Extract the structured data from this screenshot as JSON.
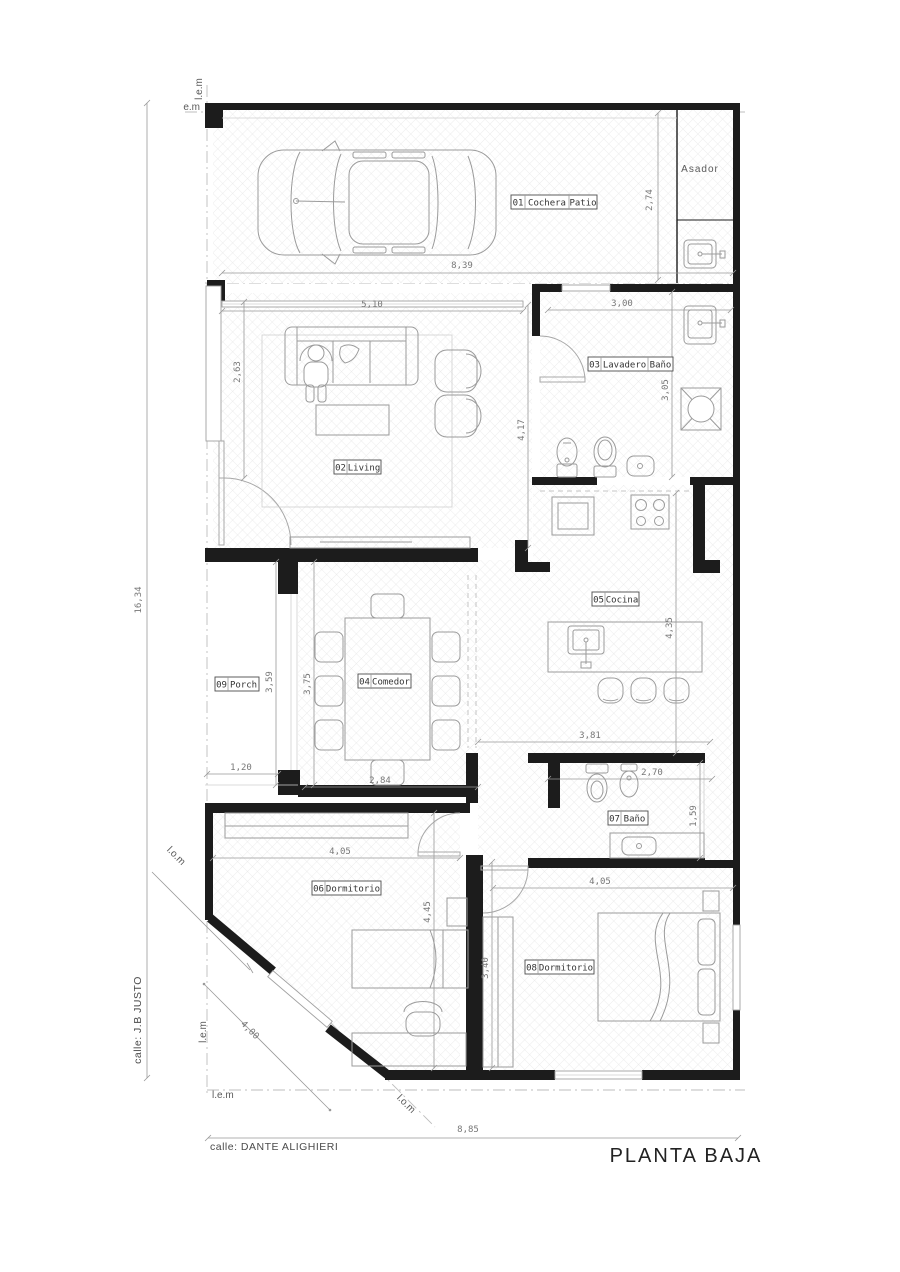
{
  "title": "PLANTA BAJA",
  "streets": {
    "left": "calle: J.B JUSTO",
    "bottom": "calle: DANTE ALIGHIERI"
  },
  "site_labels": {
    "lem_top": "l.e.m",
    "em": "e.m",
    "lem_bottom_v": "l.e.m",
    "lem_bottom_h": "l.e.m",
    "lom_upper": "l.o.m",
    "lom_lower": "l.o.m",
    "asador": "Asador"
  },
  "rooms": [
    {
      "num": "01",
      "name": "Cochera",
      "name2": "Patio"
    },
    {
      "num": "02",
      "name": "Living"
    },
    {
      "num": "03",
      "name": "Lavadero",
      "name2": "Baño"
    },
    {
      "num": "04",
      "name": "Comedor"
    },
    {
      "num": "05",
      "name": "Cocina"
    },
    {
      "num": "06",
      "name": "Dormitorio"
    },
    {
      "num": "07",
      "name": "Baño"
    },
    {
      "num": "08",
      "name": "Dormitorio"
    },
    {
      "num": "09",
      "name": "Porch"
    }
  ],
  "dimensions": {
    "lot_depth": "16,34",
    "lot_width_bottom": "8,85",
    "garage_width": "8,39",
    "garage_height": "2,74",
    "living_width": "5,10",
    "living_partial": "2,63",
    "living_height": "4,17",
    "lavadero_width": "3,00",
    "lavadero_height": "3,05",
    "cocina_height": "4,35",
    "cocina_width": "3,81",
    "porch_width": "1,20",
    "porch_height": "3,59",
    "comedor_width": "2,84",
    "comedor_height": "3,75",
    "bano_width": "2,70",
    "bano_height": "1,59",
    "dorm6_width": "4,05",
    "dorm6_height": "4,45",
    "dorm6_diag": "4,00",
    "dorm8_width": "4,05",
    "dorm8_height": "3,40"
  },
  "colors": {
    "wall": "#1c1c1c",
    "furniture_line": "#9b9b9b",
    "dim_line": "#999999",
    "hatch": "#e8e8e8"
  }
}
